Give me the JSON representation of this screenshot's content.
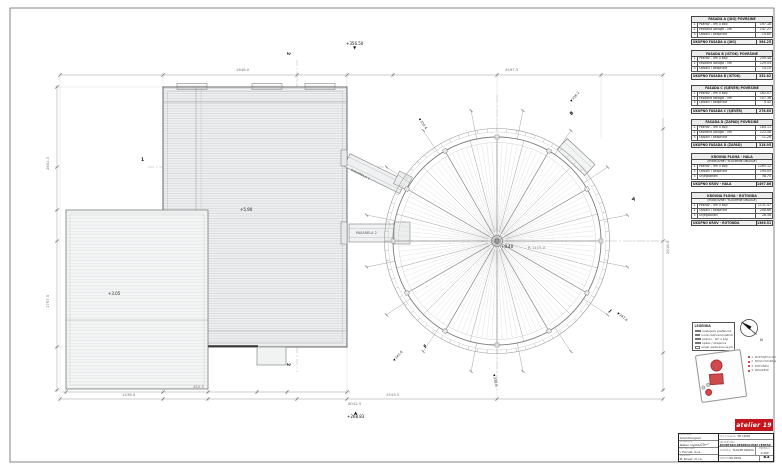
{
  "icons": {
    "level_down": "▼",
    "level_up": "▲"
  },
  "north": {
    "label": "N"
  },
  "plan": {
    "dims": [
      "1846.0",
      "4497.5",
      "2602.0",
      "1797.5",
      "1438.0",
      "2543.5",
      "6042.5",
      "2618.0",
      "452.5",
      "R 1115.0"
    ],
    "levels": [
      "+356.50",
      "+268.83",
      "+5.90",
      "+3.05",
      "+8.40"
    ],
    "rays": [
      "356.2",
      "347.6",
      "341.0",
      "350.4",
      "338.6"
    ],
    "sections": [
      "2",
      "2",
      "1",
      "A",
      "B",
      "J",
      "F"
    ],
    "walkways": [
      "PASARELA 1",
      "PASARELA 2"
    ]
  },
  "tables": [
    {
      "title": "FASADA A (JUG) POVRŠINE",
      "subtitle": "",
      "rows": [
        [
          "1",
          "Pokrov - lim u boji",
          "197.18"
        ],
        [
          "2",
          "Fasadna obloga - lim",
          "147.27"
        ],
        [
          "3",
          "Opšavi i okapnice",
          "19.80"
        ]
      ],
      "total_label": "UKUPNO FASADA A (JUG)",
      "total": "364.25"
    },
    {
      "title": "FASADA B (ISTOK) POVRŠINE",
      "subtitle": "",
      "rows": [
        [
          "1",
          "Pokrov - lim u boji",
          "209.48"
        ],
        [
          "2",
          "Fasadna obloga - lim",
          "129.04"
        ],
        [
          "3",
          "Opšavi i okapnice",
          "14.10"
        ]
      ],
      "total_label": "UKUPNO FASADA B (ISTOK)",
      "total": "352.62"
    },
    {
      "title": "FASADA C (SJEVER) POVRŠINE",
      "subtitle": "",
      "rows": [
        [
          "1",
          "Pokrov - lim u boji",
          "162.07"
        ],
        [
          "2",
          "Fasadna obloga - lim",
          "107.36"
        ],
        [
          "3",
          "Opšavi i okapnice",
          "9.42"
        ]
      ],
      "total_label": "UKUPNO FASADA C (SJEVER)",
      "total": "278.85"
    },
    {
      "title": "FASADA D (ZAPAD) POVRŠINE",
      "subtitle": "",
      "rows": [
        [
          "1",
          "Pokrov - lim u boji",
          "184.11"
        ],
        [
          "2",
          "Fasadna obloga - lim",
          "123.58"
        ],
        [
          "3",
          "Opšavi i okapnice",
          "11.26"
        ]
      ],
      "total_label": "UKUPNO FASADA D (ZAPAD)",
      "total": "318.95"
    },
    {
      "title": "KROVNA PLOHA - HALA",
      "subtitle": "(POKROVNE I TLOCRTNE OBLOGE)",
      "rows": [
        [
          "1",
          "Pokrov - lim u boji",
          "1265.12"
        ],
        [
          "2",
          "Opšavi i okapnice",
          "194.04"
        ],
        [
          "3",
          "Snjegobrani",
          "38.70"
        ]
      ],
      "total_label": "UKUPNO KROV - HALA",
      "total": "1497.86"
    },
    {
      "title": "KROVNA PLOHA - ROTONDA",
      "subtitle": "(POKROVNE I TLOCRTNE OBLOGE)",
      "rows": [
        [
          "1",
          "Pokrov - lim u boji",
          "1131.47"
        ],
        [
          "2",
          "Opšavi i okapnice",
          "208.66"
        ],
        [
          "3",
          "Snjegobrani",
          "26.38"
        ]
      ],
      "total_label": "UKUPNO KROV - ROTONDA",
      "total": "1366.51"
    }
  ],
  "legend": {
    "title": "LEGENDA",
    "items": [
      "postojeća građevina",
      "nova čelična konstrukcija",
      "pokrov - lim u boji",
      "opšav / okapnica",
      "smjer pada krovne plohe"
    ]
  },
  "sitemap_notes": [
    "1. POSTOJEĆA DVORANA",
    "2. NOVA DVORANA",
    "3. ROTONDA",
    "4. PASARELE"
  ],
  "titleblock": {
    "logo": "atelier 19",
    "rows_left": [
      {
        "label": "naručitelj",
        "value": "Grad Novigrad"
      },
      {
        "label": "projektant",
        "value": "Atelier nord d.o.o."
      },
      {
        "label": "ovl. arhitekt",
        "value": "I. Horvat, d.i.a."
      },
      {
        "label": "suradnik",
        "value": "M. Kovač, m.i.a."
      }
    ],
    "project_no_label": "broj projekta:",
    "project_no": "TD 19/06",
    "building_label": "GRAĐEVINA:",
    "building": "SPORTSKO-REKREACIJSKI CENTAR — NATKRIVANJE BAZENA I SPORTSKE DVORANE",
    "content_label": "SADRŽAJ:",
    "content": "TLOCRT KROVA",
    "scale_label": "MJERILO",
    "scale": "1:200",
    "date_label": "DATUM",
    "date": "06.2019.",
    "sheet_label": "LIST",
    "sheet": "E3"
  }
}
